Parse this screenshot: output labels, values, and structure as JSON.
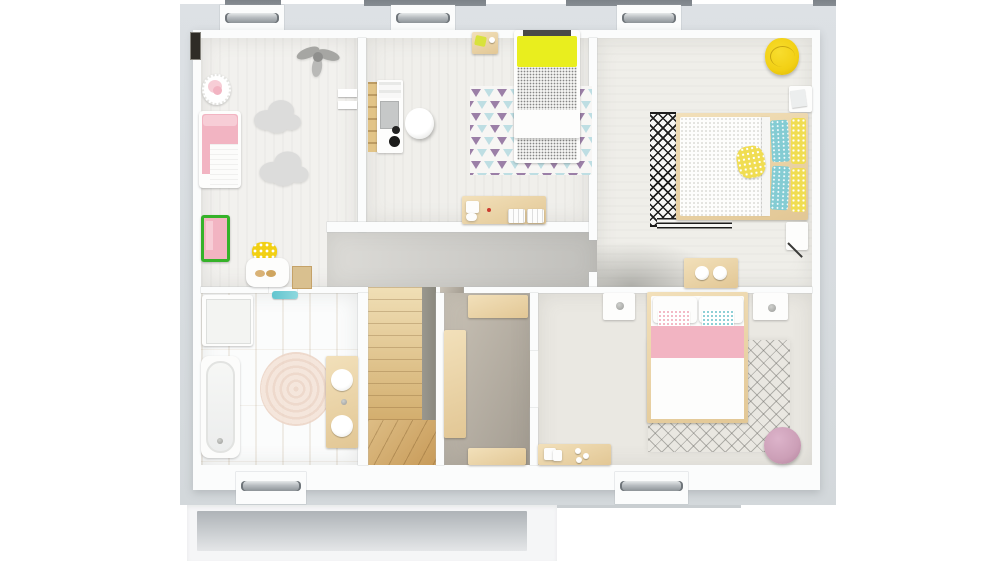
{
  "meta": {
    "title": "3D rendered floor plan — upper storey, top-down view",
    "canvas_width": 1000,
    "canvas_height": 561,
    "visible_text": "none"
  },
  "colors": {
    "page_bg": "#ffffff",
    "rim": "#dde1e5",
    "rim_dark": "#d3d8db",
    "slab": "#f5f6f7",
    "slab_inset_top": "#aeb3b7",
    "slab_inset_bottom": "#e4e6e8",
    "roof_cap": "#878d93",
    "sill": "#b7bcc0",
    "sill_dark": "#6f757a",
    "wall": "#fbfcfc",
    "wall_edge": "#c9ced1",
    "dark_slot": "#2f2c26",
    "kids_floor": "#f2f1ee",
    "middle_floor": "#f0efeb",
    "master_floor": "#efeee9",
    "hall_light": "#dcdbd7",
    "hall_dark": "#c0bfbb",
    "bath_wood_a": "#e4d3b0",
    "bath_wood_b": "#efe1c1",
    "stair_light": "#f0dfb6",
    "stair_dark": "#c89b59",
    "rail": "#8a887e",
    "closet_a": "#c9c2b6",
    "closet_b": "#a39c91",
    "bedroom_floor": "#eae8e2",
    "wood_a": "#f2e0ba",
    "wood_b": "#e2c795",
    "white": "#fdfdfc",
    "pink": "#f2b4c2",
    "pink_light": "#f7cdd6",
    "yellow": "#e9ee1e",
    "yellow_gold": "#f2d014",
    "yellow_pillow": "#f0dd52",
    "teal_pillow": "#84ccd3",
    "teal_mat": "#62c5cf",
    "purple_triangle": "#9b7fa7",
    "blue_triangle": "#bedee3",
    "cloud": "#dcdcdb",
    "toy_gray": "#a6a6a3",
    "ink": "#1d1d1c",
    "green": "#35b229",
    "red": "#cc3b2e",
    "pouf": "#cc9fb7",
    "jute_a": "#ecd5c7",
    "jute_b": "#f4e4d8",
    "laptop": "#c6c8c8"
  },
  "windows": {
    "dormer_windows_top": 3,
    "windows_bottom": 2,
    "roof_segments_top": 4
  },
  "rooms": [
    {
      "id": "kids-room",
      "position": "top-left",
      "furniture": [
        "toddler-bed",
        "toy-basket",
        "hanging-mobile-toy",
        "cloud-rug-small",
        "cloud-rug-large",
        "toy-chest",
        "play-stool",
        "play-table",
        "door-mat",
        "wall-shelves",
        "dark-wall-slot"
      ]
    },
    {
      "id": "bedroom-middle",
      "position": "top-center",
      "furniture": [
        "bedside-table",
        "single-bed-yellow-blanket",
        "triangle-pattern-rug",
        "ladder-desk",
        "laptop",
        "desk-lamp",
        "egg-chair",
        "dresser-console"
      ]
    },
    {
      "id": "master-bedroom",
      "position": "top-right",
      "furniture": [
        "round-yellow-chair",
        "nightstand-papers",
        "double-bed-yellow-teal-pillows",
        "diamond-runner-rug",
        "striped-foot-rug",
        "storage-bench-knobs",
        "wall-shelf-diagonal-item"
      ]
    },
    {
      "id": "hallway",
      "position": "center",
      "furniture": []
    },
    {
      "id": "bathroom",
      "position": "bottom-left",
      "furniture": [
        "shower-tray",
        "bathtub",
        "round-jute-rug",
        "double-sink-vanity",
        "teal-bath-mat"
      ]
    },
    {
      "id": "staircase",
      "position": "bottom-center-left",
      "furniture": [
        "straight-flight",
        "winder-steps",
        "railing-strip"
      ]
    },
    {
      "id": "dressing-room",
      "position": "bottom-center",
      "furniture": [
        "wardrobe-tall",
        "wardrobe-top",
        "wardrobe-bottom"
      ]
    },
    {
      "id": "bedroom-2",
      "position": "bottom-right",
      "furniture": [
        "nightstand-left",
        "nightstand-right",
        "double-bed-pink-blanket",
        "lattice-rug",
        "console-shelf",
        "round-pouf"
      ]
    }
  ]
}
